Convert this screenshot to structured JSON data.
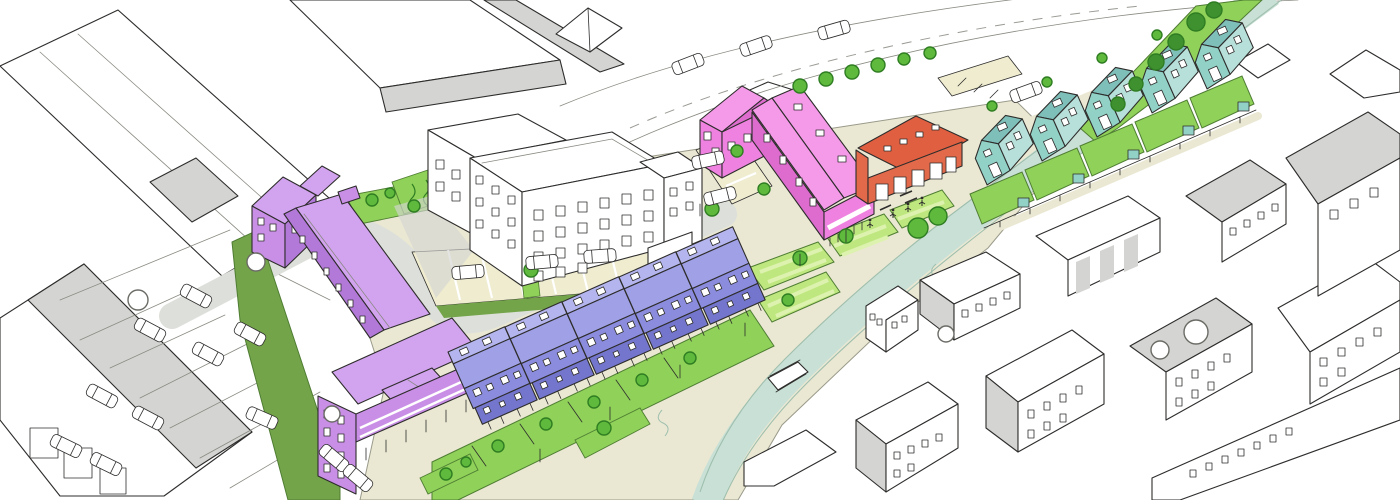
{
  "scene": {
    "kind": "hand-drawn aerial masterplan sketch of a riverside mixed-use development",
    "colored_new_buildings": [
      {
        "name": "purple-apartment-block",
        "shape": "L-shaped block with long roof slab and balcony wing",
        "color_ref": "purpleWall"
      },
      {
        "name": "blue-terrace-row",
        "units": 5,
        "shape": "stepped gabled terraces with front gardens",
        "color_ref": "blueWall"
      },
      {
        "name": "pink-apartment-building",
        "shape": "L-shaped gabled building with arcade end",
        "color_ref": "pinkWall"
      },
      {
        "name": "orange-barn-hall",
        "shape": "single gabled hall with rooflights and arcade front",
        "color_ref": "orangeWall"
      },
      {
        "name": "teal-house-row",
        "units": 5,
        "shape": "detached gabled houses with rear gardens and sheds",
        "color_ref": "tealWall"
      }
    ],
    "context": [
      "white-apartment-building",
      "industrial-sheds-left",
      "warehouses-top",
      "urban-blocks-right",
      "parking-lots",
      "top-road-with-cars"
    ],
    "landscape": [
      "river",
      "riverside-promenade",
      "striped-pocket-park",
      "terrace-gardens",
      "street-trees",
      "green-buffer-strip"
    ],
    "counts": {
      "blue_terrace_units": 5,
      "teal_house_units": 5,
      "pocket_park_patches": 4,
      "striped_lawns": true
    }
  },
  "palette": {
    "paper": "#ffffff",
    "shade": "#d4d5d3",
    "road": "#dde0da",
    "street": "#eae8d3",
    "bays": "#efecd0",
    "lawn": "#8fd159",
    "lawnLight": "#bfe77f",
    "lawnStripe": "#dcf2ae",
    "olive": "#74a44a",
    "oliveDark": "#4f7d33",
    "river": "#c9e0d6",
    "riverEdge": "#9fbfae",
    "treeFill": "#5eb93c",
    "treeStroke": "#2f7d22",
    "treeDark": "#3f9130",
    "purpleWall": "#c98fe6",
    "purpleRoof": "#d2a3ef",
    "purpleDark": "#b379d8",
    "blueWall": "#8b8cdd",
    "blueRoof": "#9fa0e6",
    "blueRoofTop": "#b4b5ee",
    "blueDark": "#7476cd",
    "pinkWall": "#ef82e0",
    "pinkRoof": "#f49ae8",
    "pinkDark": "#dd6cce",
    "orangeWall": "#e2694a",
    "orangeRoof": "#e05f40",
    "tealWall": "#92d1c6",
    "tealRoof": "#7fbfba",
    "tealLight": "#b8e0da",
    "tealDark": "#66a8a4"
  }
}
